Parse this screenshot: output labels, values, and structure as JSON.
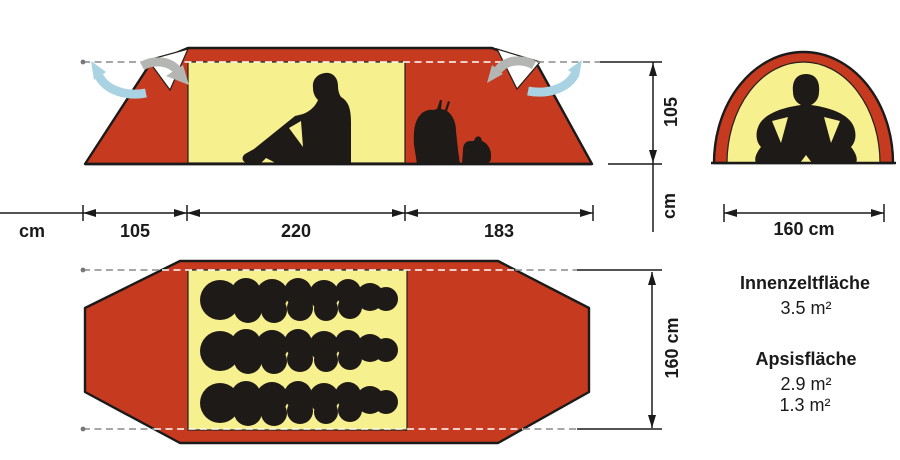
{
  "colors": {
    "tent_red": "#c63a20",
    "inner_yellow": "#f7f08f",
    "silhouette": "#1e1a17",
    "arrow_blue": "#a9d3e3",
    "arrow_gray": "#b3b6b2",
    "line_dark": "#1a1a1a",
    "dash_gray": "#8a8a8a"
  },
  "side_view": {
    "width_left": "105",
    "width_middle": "220",
    "width_right": "183",
    "width_unit": "cm",
    "height": "105",
    "height_unit": "cm"
  },
  "front_view": {
    "width": "160 cm"
  },
  "floor_plan": {
    "width": "160 cm"
  },
  "areas": {
    "inner_title": "Innenzeltfläche",
    "inner_value": "3.5 m²",
    "apse_title": "Apsisfläche",
    "apse_value_1": "2.9 m²",
    "apse_value_2": "1.3 m²"
  }
}
